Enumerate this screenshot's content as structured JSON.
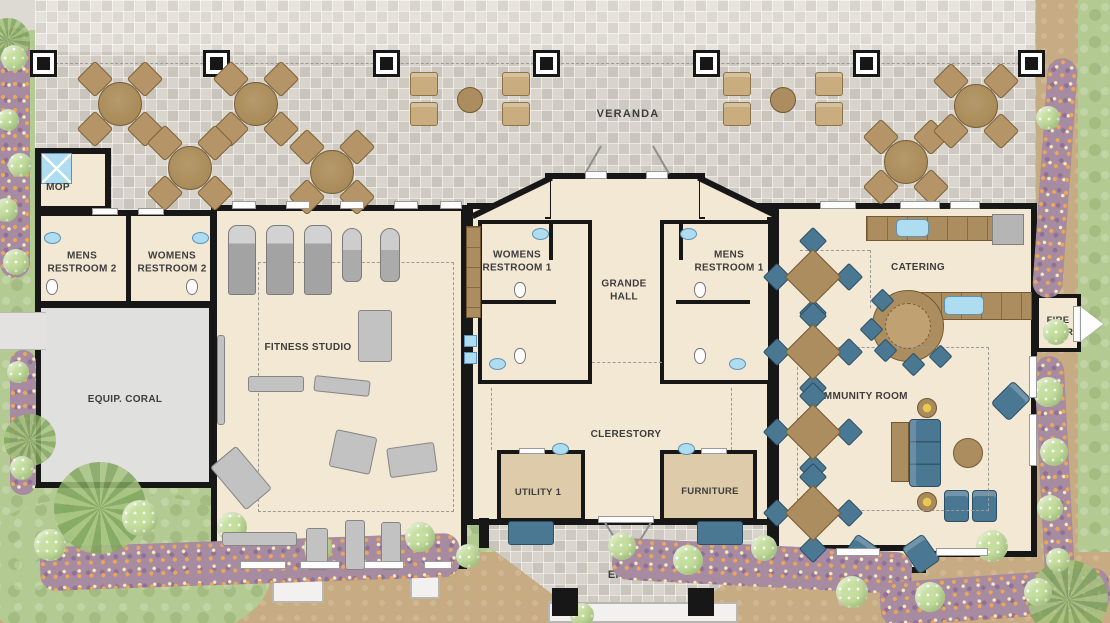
{
  "labels": {
    "veranda": "VERANDA",
    "mop": "MOP",
    "mens_restroom_2": "MENS RESTROOM 2",
    "womens_restroom_2": "WOMENS RESTROOM 2",
    "womens_restroom_1": "WOMENS RESTROOM 1",
    "grande_hall": "GRANDE HALL",
    "mens_restroom_1": "MENS RESTROOM 1",
    "catering": "CATERING",
    "fire_riser": "FIRE RISER",
    "fitness_studio": "FITNESS STUDIO",
    "equip_coral": "EQUIP. CORAL",
    "community_room": "COMMUNITY ROOM",
    "clerestory": "CLERESTORY",
    "utility_1": "UTILITY 1",
    "furniture": "FURNITURE",
    "entry": "ENTRY"
  },
  "colors": {
    "wall": "#171717",
    "floor": "#f3e8d3",
    "floor_tan": "#decbaa",
    "coral_floor": "#e0e0df",
    "veranda_paver": "#d6d1c9",
    "paver_light": "#e4e0d9",
    "wood": "#ac8d60",
    "blue": "#4a7791",
    "fixture_blue": "#aedcf0",
    "equipment_gray": "#c2c2c2",
    "grass": "#b3ca93",
    "flowerbed": "#a78ba0",
    "flower_accent": "#eca659",
    "path": "#c7ab82",
    "label_text": "#3d3d3d"
  }
}
